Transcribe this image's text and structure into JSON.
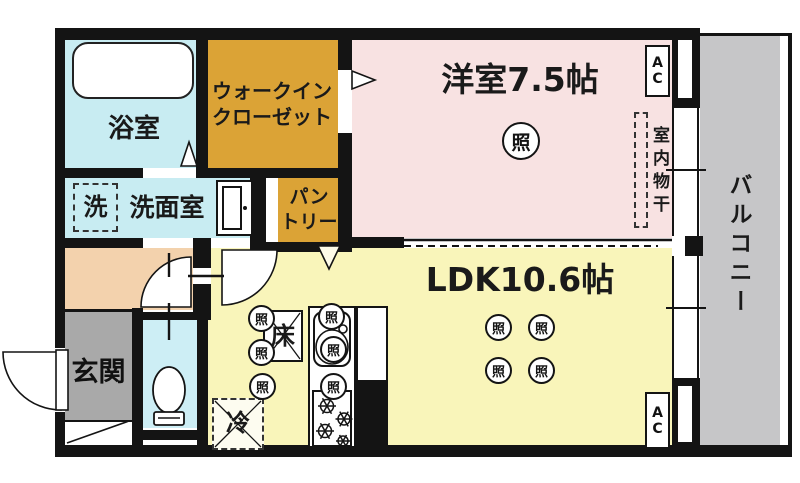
{
  "plan": {
    "rooms": {
      "bath": "浴室",
      "walk_in_closet": "ウォークイン\nクローゼット",
      "washroom": "洗面室",
      "pantry": "パン\nトリー",
      "western_room": "洋室7.5帖",
      "ldk": "LDK10.6帖",
      "entrance": "玄関",
      "balcony": "バルコニー"
    },
    "symbols": {
      "light": "照",
      "washer": "洗",
      "fridge": "冷",
      "floor_storage": "床",
      "indoor_drying": "室内物干",
      "ac": "AC"
    }
  }
}
